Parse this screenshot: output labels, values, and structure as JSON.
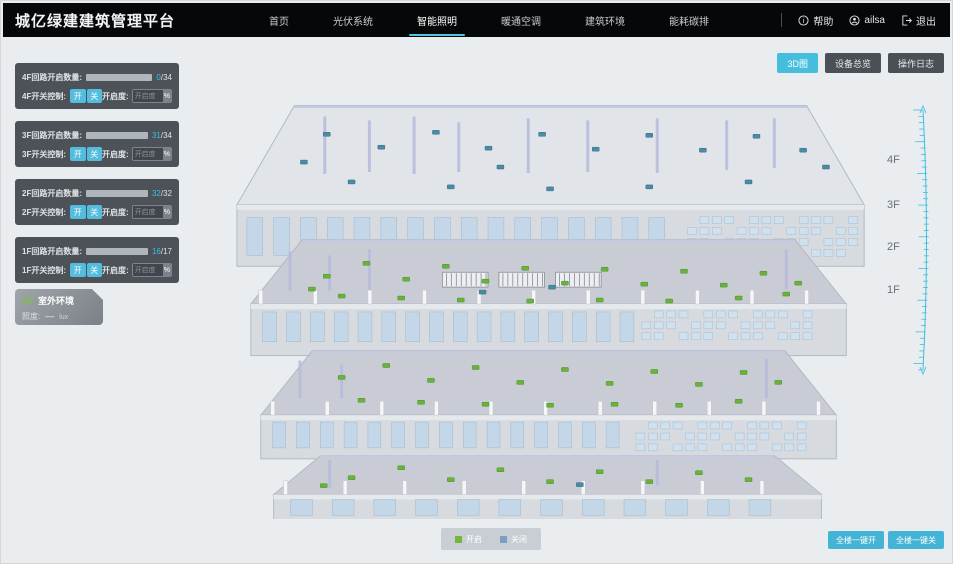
{
  "app_title": "城亿绿建建筑管理平台",
  "nav": {
    "items": [
      {
        "label": "首页",
        "active": false
      },
      {
        "label": "光伏系统",
        "active": false
      },
      {
        "label": "智能照明",
        "active": true
      },
      {
        "label": "暖通空调",
        "active": false
      },
      {
        "label": "建筑环境",
        "active": false
      },
      {
        "label": "能耗碳排",
        "active": false
      }
    ],
    "help_label": "帮助",
    "username": "ailsa",
    "logout_label": "退出"
  },
  "view_toolbar": {
    "buttons": [
      {
        "label": "3D图",
        "active": true
      },
      {
        "label": "设备总览",
        "active": false
      },
      {
        "label": "操作日志",
        "active": false
      }
    ]
  },
  "floor_panels": [
    {
      "floor": "4F",
      "circuit_label": "4F回路开启数量:",
      "open": 0,
      "total": 34,
      "open_count": "0",
      "total_label": "/34",
      "switch_label": "4F开关控制:",
      "on_label": "开",
      "off_label": "关",
      "dim_label": "开启度:",
      "dim_placeholder": "开启度",
      "dim_unit": "%"
    },
    {
      "floor": "3F",
      "circuit_label": "3F回路开启数量:",
      "open": 31,
      "total": 34,
      "open_count": "31",
      "total_label": "/34",
      "switch_label": "3F开关控制:",
      "on_label": "开",
      "off_label": "关",
      "dim_label": "开启度:",
      "dim_placeholder": "开启度",
      "dim_unit": "%"
    },
    {
      "floor": "2F",
      "circuit_label": "2F回路开启数量:",
      "open": 32,
      "total": 32,
      "open_count": "32",
      "total_label": "/32",
      "switch_label": "2F开关控制:",
      "on_label": "开",
      "off_label": "关",
      "dim_label": "开启度:",
      "dim_placeholder": "开启度",
      "dim_unit": "%"
    },
    {
      "floor": "1F",
      "circuit_label": "1F回路开启数量:",
      "open": 16,
      "total": 17,
      "open_count": "16",
      "total_label": "/17",
      "switch_label": "1F开关控制:",
      "on_label": "开",
      "off_label": "关",
      "dim_label": "开启度:",
      "dim_placeholder": "开启度",
      "dim_unit": "%"
    }
  ],
  "outdoor_panel": {
    "title": "室外环境",
    "metric_label": "照度:",
    "metric_value": "—",
    "metric_unit": "lux"
  },
  "floor_axis_labels": [
    "4F",
    "3F",
    "2F",
    "1F"
  ],
  "legend": {
    "items": [
      {
        "label": "开启",
        "color": "#76b43c"
      },
      {
        "label": "关闭",
        "color": "#7d9fc4"
      }
    ]
  },
  "bulk_actions": {
    "buttons": [
      {
        "label": "全楼一键开"
      },
      {
        "label": "全楼一键关"
      }
    ]
  },
  "colors": {
    "accent": "#3fbddf",
    "light_on": "#69b23b",
    "light_off": "#4a8ba6"
  },
  "building": {
    "floors": [
      {
        "name": "4F",
        "lights_on": [],
        "lights_off": [
          [
            95,
            42
          ],
          [
            150,
            55
          ],
          [
            205,
            40
          ],
          [
            258,
            56
          ],
          [
            312,
            42
          ],
          [
            366,
            57
          ],
          [
            420,
            43
          ],
          [
            474,
            58
          ],
          [
            528,
            44
          ],
          [
            575,
            58
          ],
          [
            120,
            90
          ],
          [
            220,
            95
          ],
          [
            320,
            97
          ],
          [
            420,
            95
          ],
          [
            520,
            90
          ],
          [
            598,
            75
          ],
          [
            72,
            70
          ],
          [
            270,
            75
          ]
        ]
      },
      {
        "name": "3F",
        "lights_on": [
          [
            95,
            185
          ],
          [
            135,
            172
          ],
          [
            175,
            188
          ],
          [
            215,
            175
          ],
          [
            255,
            190
          ],
          [
            295,
            177
          ],
          [
            335,
            192
          ],
          [
            375,
            178
          ],
          [
            415,
            193
          ],
          [
            455,
            180
          ],
          [
            495,
            194
          ],
          [
            535,
            182
          ],
          [
            570,
            192
          ],
          [
            110,
            205
          ],
          [
            170,
            207
          ],
          [
            230,
            209
          ],
          [
            300,
            210
          ],
          [
            370,
            209
          ],
          [
            440,
            210
          ],
          [
            510,
            207
          ],
          [
            558,
            203
          ],
          [
            80,
            198
          ]
        ],
        "lights_off": [
          [
            322,
            196
          ],
          [
            252,
            201
          ]
        ]
      },
      {
        "name": "2F",
        "lights_on": [
          [
            110,
            287
          ],
          [
            155,
            275
          ],
          [
            200,
            290
          ],
          [
            245,
            277
          ],
          [
            290,
            292
          ],
          [
            335,
            279
          ],
          [
            380,
            293
          ],
          [
            425,
            281
          ],
          [
            470,
            294
          ],
          [
            515,
            282
          ],
          [
            550,
            292
          ],
          [
            130,
            310
          ],
          [
            190,
            312
          ],
          [
            255,
            314
          ],
          [
            320,
            315
          ],
          [
            385,
            314
          ],
          [
            450,
            315
          ],
          [
            510,
            311
          ]
        ],
        "lights_off": []
      },
      {
        "name": "1F",
        "lights_on": [
          [
            120,
            388
          ],
          [
            170,
            378
          ],
          [
            220,
            390
          ],
          [
            270,
            380
          ],
          [
            320,
            392
          ],
          [
            370,
            382
          ],
          [
            420,
            392
          ],
          [
            470,
            383
          ],
          [
            520,
            390
          ],
          [
            92,
            396
          ]
        ],
        "lights_off": [
          [
            350,
            395
          ]
        ]
      }
    ]
  }
}
